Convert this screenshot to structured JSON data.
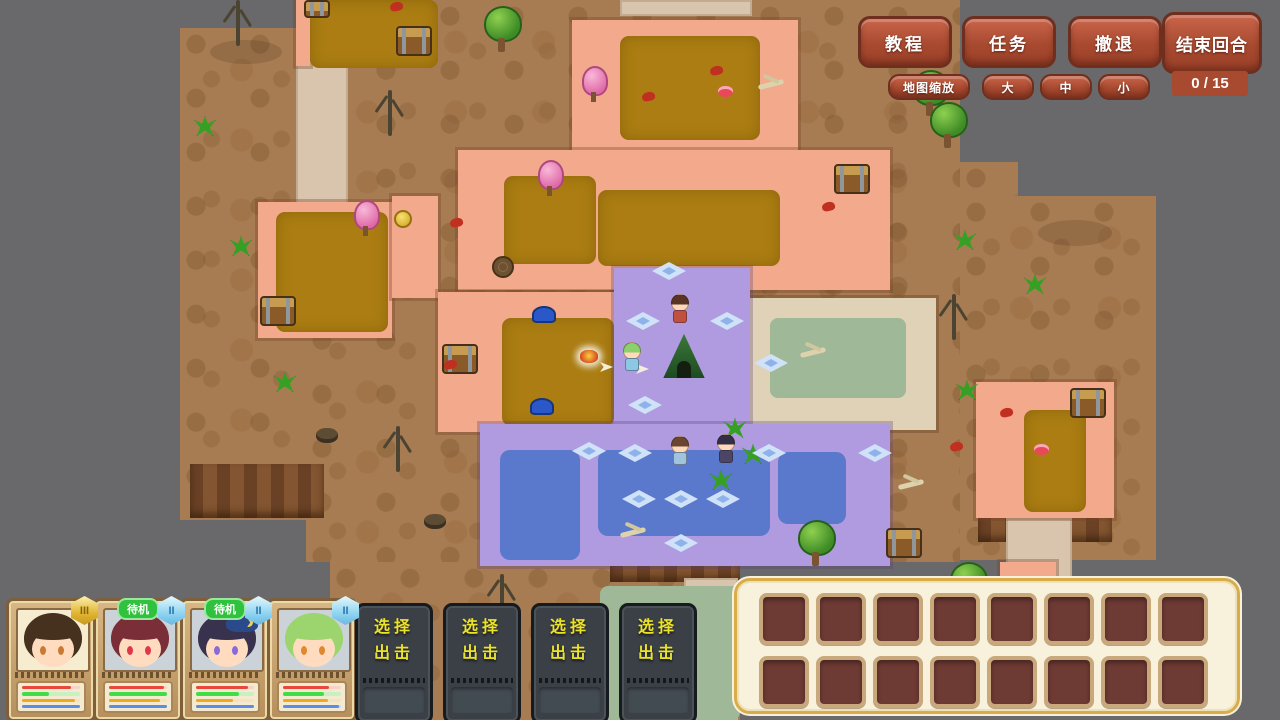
{
  "hud": {
    "buttons": [
      {
        "id": "tutorial",
        "label": "教程"
      },
      {
        "id": "quest",
        "label": "任务"
      },
      {
        "id": "retreat",
        "label": "撤退"
      },
      {
        "id": "end_turn",
        "label": "结束回合"
      }
    ],
    "turn_counter": "0 / 15",
    "map_zoom": {
      "label": "地图缩放",
      "options": [
        "大",
        "中",
        "小"
      ]
    }
  },
  "party": {
    "members": [
      {
        "badge": "III",
        "tier": "gold",
        "standby": "",
        "portrait": {
          "bg": "#f6eccf",
          "hair": "#46311f",
          "skin": "#ffdcc0",
          "eye": "#c87a32"
        },
        "bars": [
          {
            "c": "#e8483c",
            "t": "#f8d2c6",
            "pct": 85
          },
          {
            "c": "#42dc46",
            "t": "#c8f0c0",
            "pct": 46
          },
          {
            "c": "#f0a81e",
            "t": "#f6e2bc",
            "pct": 92
          },
          {
            "c": "#5c8ce8",
            "t": "#c6d6f6",
            "pct": 100
          }
        ]
      },
      {
        "badge": "II",
        "tier": "blue",
        "standby": "待机",
        "portrait": {
          "bg": "#ccd3d8",
          "hair": "#7a2e38",
          "skin": "#ffdcc0",
          "eye": "#e03848"
        },
        "bars": [
          {
            "c": "#e8483c",
            "t": "#f8d2c6",
            "pct": 95
          },
          {
            "c": "#42dc46",
            "t": "#c8f0c0",
            "pct": 100
          },
          {
            "c": "#f0a81e",
            "t": "#f6e2bc",
            "pct": 88
          },
          {
            "c": "#5c8ce8",
            "t": "#c6d6f6",
            "pct": 100
          }
        ]
      },
      {
        "badge": "II",
        "tier": "blue",
        "standby": "待机",
        "hat": "#2a4a8c",
        "portrait": {
          "bg": "#ccd3d8",
          "hair": "#38324e",
          "skin": "#ffdcc0",
          "eye": "#8a6ad8"
        },
        "bars": [
          {
            "c": "#e8483c",
            "t": "#f8d2c6",
            "pct": 90
          },
          {
            "c": "#42dc46",
            "t": "#c8f0c0",
            "pct": 74
          },
          {
            "c": "#f0a81e",
            "t": "#f6e2bc",
            "pct": 64
          },
          {
            "c": "#5c8ce8",
            "t": "#c6d6f6",
            "pct": 100
          }
        ]
      },
      {
        "badge": "II",
        "tier": "blue",
        "standby": "",
        "portrait": {
          "bg": "#ccd3d8",
          "hair": "#9cd46e",
          "skin": "#ffdcc0",
          "eye": "#e08830"
        },
        "bars": [
          {
            "c": "#e8483c",
            "t": "#f8d2c6",
            "pct": 80
          },
          {
            "c": "#42dc46",
            "t": "#c8f0c0",
            "pct": 70
          },
          {
            "c": "#f0a81e",
            "t": "#f6e2bc",
            "pct": 78
          },
          {
            "c": "#5c8ce8",
            "t": "#c6d6f6",
            "pct": 96
          }
        ]
      }
    ]
  },
  "deploy": {
    "line1": "选择",
    "line2": "出击",
    "count": 4
  },
  "inventory": {
    "rows": 2,
    "cols": 8
  },
  "colors": {
    "wood": "#a84a30",
    "panel_gold": "#d8ac48",
    "deploy_text": "#ece22c",
    "standby_green": "#30c23e"
  },
  "map": {
    "terrain": [
      {
        "c": "brown",
        "x": 180,
        "y": 28,
        "w": 126,
        "h": 492
      },
      {
        "c": "brown",
        "x": 306,
        "y": 0,
        "w": 654,
        "h": 562
      },
      {
        "c": "brown",
        "x": 330,
        "y": 562,
        "w": 410,
        "h": 158
      },
      {
        "c": "brown",
        "x": 960,
        "y": 162,
        "w": 58,
        "h": 36
      },
      {
        "c": "brown",
        "x": 960,
        "y": 196,
        "w": 196,
        "h": 364
      },
      {
        "c": "cliff",
        "x": 190,
        "y": 464,
        "w": 134,
        "h": 54
      },
      {
        "c": "cliff",
        "x": 610,
        "y": 560,
        "w": 130,
        "h": 22
      },
      {
        "c": "cliff",
        "x": 978,
        "y": 516,
        "w": 134,
        "h": 26
      },
      {
        "c": "tan",
        "x": 296,
        "y": 60,
        "w": 52,
        "h": 148
      },
      {
        "c": "tan",
        "x": 620,
        "y": 0,
        "w": 132,
        "h": 16
      },
      {
        "c": "tan",
        "x": 1006,
        "y": 518,
        "w": 66,
        "h": 62
      },
      {
        "c": "tan",
        "x": 684,
        "y": 578,
        "w": 54,
        "h": 142
      },
      {
        "c": "tanroom",
        "x": 748,
        "y": 298,
        "w": 188,
        "h": 132
      },
      {
        "c": "sage",
        "x": 770,
        "y": 318,
        "w": 136,
        "h": 80
      },
      {
        "c": "sage",
        "x": 600,
        "y": 586,
        "w": 140,
        "h": 134
      },
      {
        "c": "salmon",
        "x": 296,
        "y": 0,
        "w": 14,
        "h": 66
      },
      {
        "c": "mustard",
        "x": 310,
        "y": 0,
        "w": 128,
        "h": 68
      },
      {
        "c": "salmon",
        "x": 572,
        "y": 20,
        "w": 226,
        "h": 132
      },
      {
        "c": "mustard",
        "x": 620,
        "y": 36,
        "w": 140,
        "h": 104
      },
      {
        "c": "salmon",
        "x": 458,
        "y": 150,
        "w": 432,
        "h": 140
      },
      {
        "c": "mustard",
        "x": 504,
        "y": 176,
        "w": 92,
        "h": 88
      },
      {
        "c": "mustard",
        "x": 598,
        "y": 190,
        "w": 182,
        "h": 76
      },
      {
        "c": "salmon",
        "x": 258,
        "y": 202,
        "w": 134,
        "h": 136
      },
      {
        "c": "mustard",
        "x": 276,
        "y": 212,
        "w": 112,
        "h": 120
      },
      {
        "c": "salmon",
        "x": 392,
        "y": 196,
        "w": 46,
        "h": 102
      },
      {
        "c": "salmon",
        "x": 438,
        "y": 292,
        "w": 202,
        "h": 140
      },
      {
        "c": "mustard",
        "x": 502,
        "y": 318,
        "w": 112,
        "h": 108
      },
      {
        "c": "purple",
        "x": 614,
        "y": 268,
        "w": 136,
        "h": 164
      },
      {
        "c": "purple",
        "x": 480,
        "y": 424,
        "w": 410,
        "h": 142
      },
      {
        "c": "blue",
        "x": 500,
        "y": 450,
        "w": 80,
        "h": 110
      },
      {
        "c": "blue",
        "x": 598,
        "y": 450,
        "w": 172,
        "h": 86
      },
      {
        "c": "blue",
        "x": 778,
        "y": 452,
        "w": 68,
        "h": 72
      },
      {
        "c": "salmon",
        "x": 976,
        "y": 382,
        "w": 138,
        "h": 136
      },
      {
        "c": "mustard",
        "x": 1024,
        "y": 410,
        "w": 62,
        "h": 102
      },
      {
        "c": "salmon",
        "x": 1000,
        "y": 562,
        "w": 56,
        "h": 16
      }
    ],
    "objects": [
      {
        "t": "shadow",
        "x": 210,
        "y": 40,
        "w": 72,
        "h": 24
      },
      {
        "t": "shadow",
        "x": 1038,
        "y": 220,
        "w": 74,
        "h": 26
      },
      {
        "t": "chest",
        "x": 396,
        "y": 26
      },
      {
        "t": "chest",
        "x": 304,
        "y": 0,
        "w": 22,
        "h": 14
      },
      {
        "t": "chest",
        "x": 834,
        "y": 164
      },
      {
        "t": "chest",
        "x": 260,
        "y": 296
      },
      {
        "t": "chest",
        "x": 442,
        "y": 344
      },
      {
        "t": "chest",
        "x": 1070,
        "y": 388
      },
      {
        "t": "chest",
        "x": 886,
        "y": 528
      },
      {
        "t": "tree",
        "x": 484,
        "y": 6
      },
      {
        "t": "tree",
        "x": 912,
        "y": 70
      },
      {
        "t": "tree",
        "x": 930,
        "y": 102
      },
      {
        "t": "tree",
        "x": 798,
        "y": 520
      },
      {
        "t": "tree",
        "x": 950,
        "y": 562
      },
      {
        "t": "treeblue",
        "x": 890,
        "y": 382
      },
      {
        "t": "pinktree",
        "x": 354,
        "y": 200
      },
      {
        "t": "pinktree",
        "x": 582,
        "y": 66
      },
      {
        "t": "pinktree",
        "x": 538,
        "y": 160
      },
      {
        "t": "dead",
        "x": 388,
        "y": 90
      },
      {
        "t": "dead",
        "x": 396,
        "y": 426
      },
      {
        "t": "dead",
        "x": 500,
        "y": 574
      },
      {
        "t": "dead",
        "x": 952,
        "y": 294
      },
      {
        "t": "dead",
        "x": 236,
        "y": 0
      },
      {
        "t": "plant",
        "x": 194,
        "y": 116
      },
      {
        "t": "plant",
        "x": 230,
        "y": 236
      },
      {
        "t": "plant",
        "x": 274,
        "y": 372
      },
      {
        "t": "plant",
        "x": 710,
        "y": 470
      },
      {
        "t": "plant",
        "x": 954,
        "y": 230
      },
      {
        "t": "plant",
        "x": 1024,
        "y": 274
      },
      {
        "t": "plant",
        "x": 956,
        "y": 380
      },
      {
        "t": "plant",
        "x": 724,
        "y": 418
      },
      {
        "t": "plant",
        "x": 742,
        "y": 444
      },
      {
        "t": "rock",
        "x": 316,
        "y": 428
      },
      {
        "t": "rock",
        "x": 424,
        "y": 514
      },
      {
        "t": "stump",
        "x": 492,
        "y": 256
      },
      {
        "t": "camp",
        "x": 580,
        "y": 350
      },
      {
        "t": "blueitem",
        "x": 532,
        "y": 306
      },
      {
        "t": "blueitem",
        "x": 530,
        "y": 398
      },
      {
        "t": "cake",
        "x": 718,
        "y": 86
      },
      {
        "t": "cake",
        "x": 1034,
        "y": 444
      },
      {
        "t": "red",
        "x": 390,
        "y": 2
      },
      {
        "t": "red",
        "x": 642,
        "y": 92
      },
      {
        "t": "red",
        "x": 710,
        "y": 66
      },
      {
        "t": "red",
        "x": 822,
        "y": 202
      },
      {
        "t": "red",
        "x": 450,
        "y": 218
      },
      {
        "t": "red",
        "x": 950,
        "y": 442
      },
      {
        "t": "red",
        "x": 1000,
        "y": 408
      },
      {
        "t": "red",
        "x": 444,
        "y": 360
      },
      {
        "t": "gold",
        "x": 394,
        "y": 210
      },
      {
        "t": "bones",
        "x": 758,
        "y": 82
      },
      {
        "t": "bones",
        "x": 800,
        "y": 350
      },
      {
        "t": "bones",
        "x": 620,
        "y": 530
      },
      {
        "t": "bones",
        "x": 898,
        "y": 482
      },
      {
        "t": "snow",
        "x": 626,
        "y": 312
      },
      {
        "t": "snow",
        "x": 710,
        "y": 312
      },
      {
        "t": "snow",
        "x": 628,
        "y": 396
      },
      {
        "t": "snow",
        "x": 652,
        "y": 262
      },
      {
        "t": "snow",
        "x": 572,
        "y": 442
      },
      {
        "t": "snow",
        "x": 618,
        "y": 444
      },
      {
        "t": "snow",
        "x": 752,
        "y": 444
      },
      {
        "t": "snow",
        "x": 858,
        "y": 444
      },
      {
        "t": "snow",
        "x": 622,
        "y": 490
      },
      {
        "t": "snow",
        "x": 664,
        "y": 490
      },
      {
        "t": "snow",
        "x": 706,
        "y": 490
      },
      {
        "t": "snow",
        "x": 664,
        "y": 534
      },
      {
        "t": "snow",
        "x": 754,
        "y": 354
      },
      {
        "t": "arrow",
        "x": 600,
        "y": 362
      },
      {
        "t": "arrow",
        "x": 636,
        "y": 364
      },
      {
        "t": "tent",
        "x": 662,
        "y": 332
      },
      {
        "t": "char",
        "x": 670,
        "y": 294,
        "hair": "#5a3424",
        "cloth": "#c05040"
      },
      {
        "t": "char",
        "x": 622,
        "y": 342,
        "hair": "#8cd06c",
        "cloth": "#8cc8e4"
      },
      {
        "t": "char",
        "x": 670,
        "y": 436,
        "hair": "#6a4632",
        "cloth": "#a0c4dc"
      },
      {
        "t": "char",
        "x": 716,
        "y": 434,
        "hair": "#342e46",
        "cloth": "#4c4666"
      }
    ]
  }
}
